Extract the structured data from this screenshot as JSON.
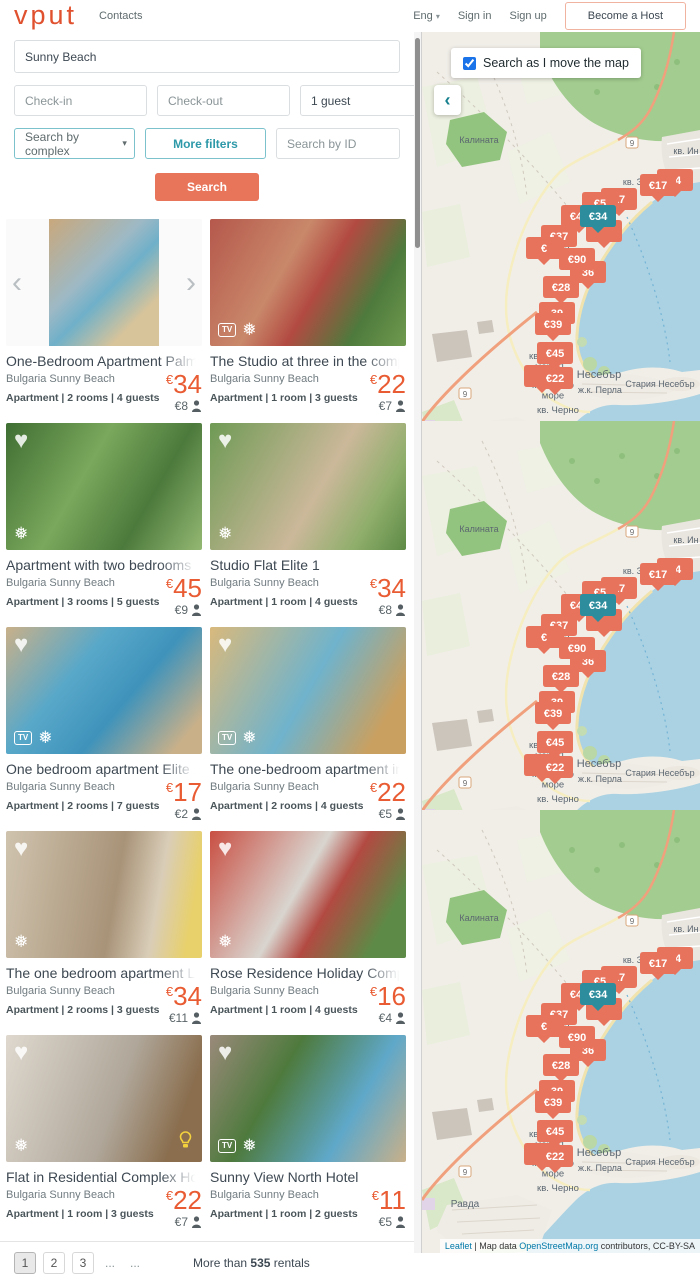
{
  "header": {
    "logo": "vput",
    "contacts": "Contacts",
    "language": "Eng",
    "sign_in": "Sign in",
    "sign_up": "Sign up",
    "become_host": "Become a Host"
  },
  "search": {
    "destination_value": "Sunny Beach",
    "checkin_placeholder": "Check-in",
    "checkout_placeholder": "Check-out",
    "guests_value": "1 guest",
    "complex_select_value": "Search by complex",
    "more_filters_label": "More filters",
    "id_placeholder": "Search by ID",
    "search_label": "Search"
  },
  "icons": {
    "heart": "♥",
    "snowflake": "❅",
    "tv": "TV",
    "prev": "‹",
    "next": "›",
    "chevron_down": "▾",
    "collapse": "‹"
  },
  "listings": [
    {
      "title": "One-Bedroom Apartment Palm Com",
      "location": "Bulgaria Sunny Beach",
      "meta": "Apartment | 2 rooms | 4 guests",
      "price_cur": "€",
      "price": "34",
      "per_person": "€8"
    },
    {
      "title": "The Studio at three in the complex S",
      "location": "Bulgaria Sunny Beach",
      "meta": "Apartment | 1 room | 3 guests",
      "price_cur": "€",
      "price": "22",
      "per_person": "€7"
    },
    {
      "title": "Apartment with two bedrooms in co",
      "location": "Bulgaria Sunny Beach",
      "meta": "Apartment | 3 rooms | 5 guests",
      "price_cur": "€",
      "price": "45",
      "per_person": "€9"
    },
    {
      "title": "Studio Flat Elite 1",
      "location": "Bulgaria Sunny Beach",
      "meta": "Apartment | 1 room | 4 guests",
      "price_cur": "€",
      "price": "34",
      "per_person": "€8"
    },
    {
      "title": "One bedroom apartment Elite 1",
      "location": "Bulgaria Sunny Beach",
      "meta": "Apartment | 2 rooms | 7 guests",
      "price_cur": "€",
      "price": "17",
      "per_person": "€2"
    },
    {
      "title": "The one-bedroom apartment in \"El",
      "location": "Bulgaria Sunny Beach",
      "meta": "Apartment | 2 rooms | 4 guests",
      "price_cur": "€",
      "price": "22",
      "per_person": "€5"
    },
    {
      "title": "The one bedroom apartment Lifest",
      "location": "Bulgaria Sunny Beach",
      "meta": "Apartment | 2 rooms | 3 guests",
      "price_cur": "€",
      "price": "34",
      "per_person": "€11"
    },
    {
      "title": "Rose Residence Holiday Complex",
      "location": "Bulgaria Sunny Beach",
      "meta": "Apartment | 1 room | 4 guests",
      "price_cur": "€",
      "price": "16",
      "per_person": "€4"
    },
    {
      "title": "Flat in Residential Complex Holiday",
      "location": "Bulgaria Sunny Beach",
      "meta": "Apartment | 1 room | 3 guests",
      "price_cur": "€",
      "price": "22",
      "per_person": "€7"
    },
    {
      "title": "Sunny View North Hotel",
      "location": "Bulgaria Sunny Beach",
      "meta": "Apartment | 1 room | 2 guests",
      "price_cur": "€",
      "price": "11",
      "per_person": "€5"
    }
  ],
  "pagination": {
    "pages": [
      "1",
      "2",
      "3"
    ],
    "active_page": "1",
    "dots1": "...",
    "dots2": "...",
    "results_prefix": "More than ",
    "results_count": "535",
    "results_suffix": " rentals"
  },
  "map": {
    "checkbox_label": "Search as I move the map",
    "checkbox_checked": true,
    "markers": [
      {
        "value": "34",
        "x": 253,
        "y": 148
      },
      {
        "value": "€17",
        "x": 236,
        "y": 153
      },
      {
        "value": "17",
        "x": 197,
        "y": 167
      },
      {
        "value": "€5",
        "x": 178,
        "y": 171,
        "partial": true
      },
      {
        "value": "",
        "x": 182,
        "y": 199,
        "partial": true
      },
      {
        "value": "€45",
        "x": 157,
        "y": 184
      },
      {
        "value": "€34",
        "x": 176,
        "y": 184,
        "selected": true
      },
      {
        "value": "€37",
        "x": 137,
        "y": 204
      },
      {
        "value": "€",
        "x": 122,
        "y": 216,
        "partial": true
      },
      {
        "value": "36",
        "x": 166,
        "y": 240,
        "partial": true
      },
      {
        "value": "€90",
        "x": 155,
        "y": 227
      },
      {
        "value": "€28",
        "x": 139,
        "y": 255
      },
      {
        "value": "39",
        "x": 135,
        "y": 281,
        "partial": true
      },
      {
        "value": "€39",
        "x": 131,
        "y": 292
      },
      {
        "value": "€45",
        "x": 133,
        "y": 321
      },
      {
        "value": "€",
        "x": 120,
        "y": 344,
        "partial": true
      },
      {
        "value": "€22",
        "x": 133,
        "y": 346
      }
    ],
    "marker_color": "#e8735c",
    "marker_selected_color": "#2d8d9d",
    "labels": [
      {
        "lines": [
          "Калината"
        ],
        "x": 57,
        "y": 111,
        "size": 9
      },
      {
        "lines": [
          "кв. Ин"
        ],
        "x": 264,
        "y": 122,
        "size": 9
      },
      {
        "lines": [
          "кв. Зо"
        ],
        "x": 213,
        "y": 153,
        "size": 9
      },
      {
        "lines": [
          "кв. Камка"
        ],
        "x": 128,
        "y": 219,
        "size": 9
      },
      {
        "lines": [
          "кв. Черно",
          "море 1"
        ],
        "x": 128,
        "y": 327,
        "size": 9.5
      },
      {
        "lines": [
          "Несебър"
        ],
        "x": 177,
        "y": 346,
        "size": 11
      },
      {
        "lines": [
          "Стария Несебър"
        ],
        "x": 238,
        "y": 355,
        "size": 9
      },
      {
        "lines": [
          "кв. Черно",
          "море"
        ],
        "x": 131,
        "y": 356,
        "size": 9.5
      },
      {
        "lines": [
          "ж.к. Перла"
        ],
        "x": 178,
        "y": 361,
        "size": 9
      },
      {
        "lines": [
          "кв. Черно"
        ],
        "x": 136,
        "y": 381,
        "size": 9.5
      },
      {
        "lines": [
          "Равда"
        ],
        "x": 43,
        "y": 397,
        "size": 10
      }
    ],
    "road_badges": [
      {
        "value": "9",
        "x": 210,
        "y": 112
      },
      {
        "value": "9",
        "x": 43,
        "y": 363
      }
    ],
    "attribution": {
      "leaflet": "Leaflet",
      "sep": " | Map data ",
      "osm": "OpenStreetMap.org",
      "suffix": " contributors, CC-BY-SA"
    }
  }
}
